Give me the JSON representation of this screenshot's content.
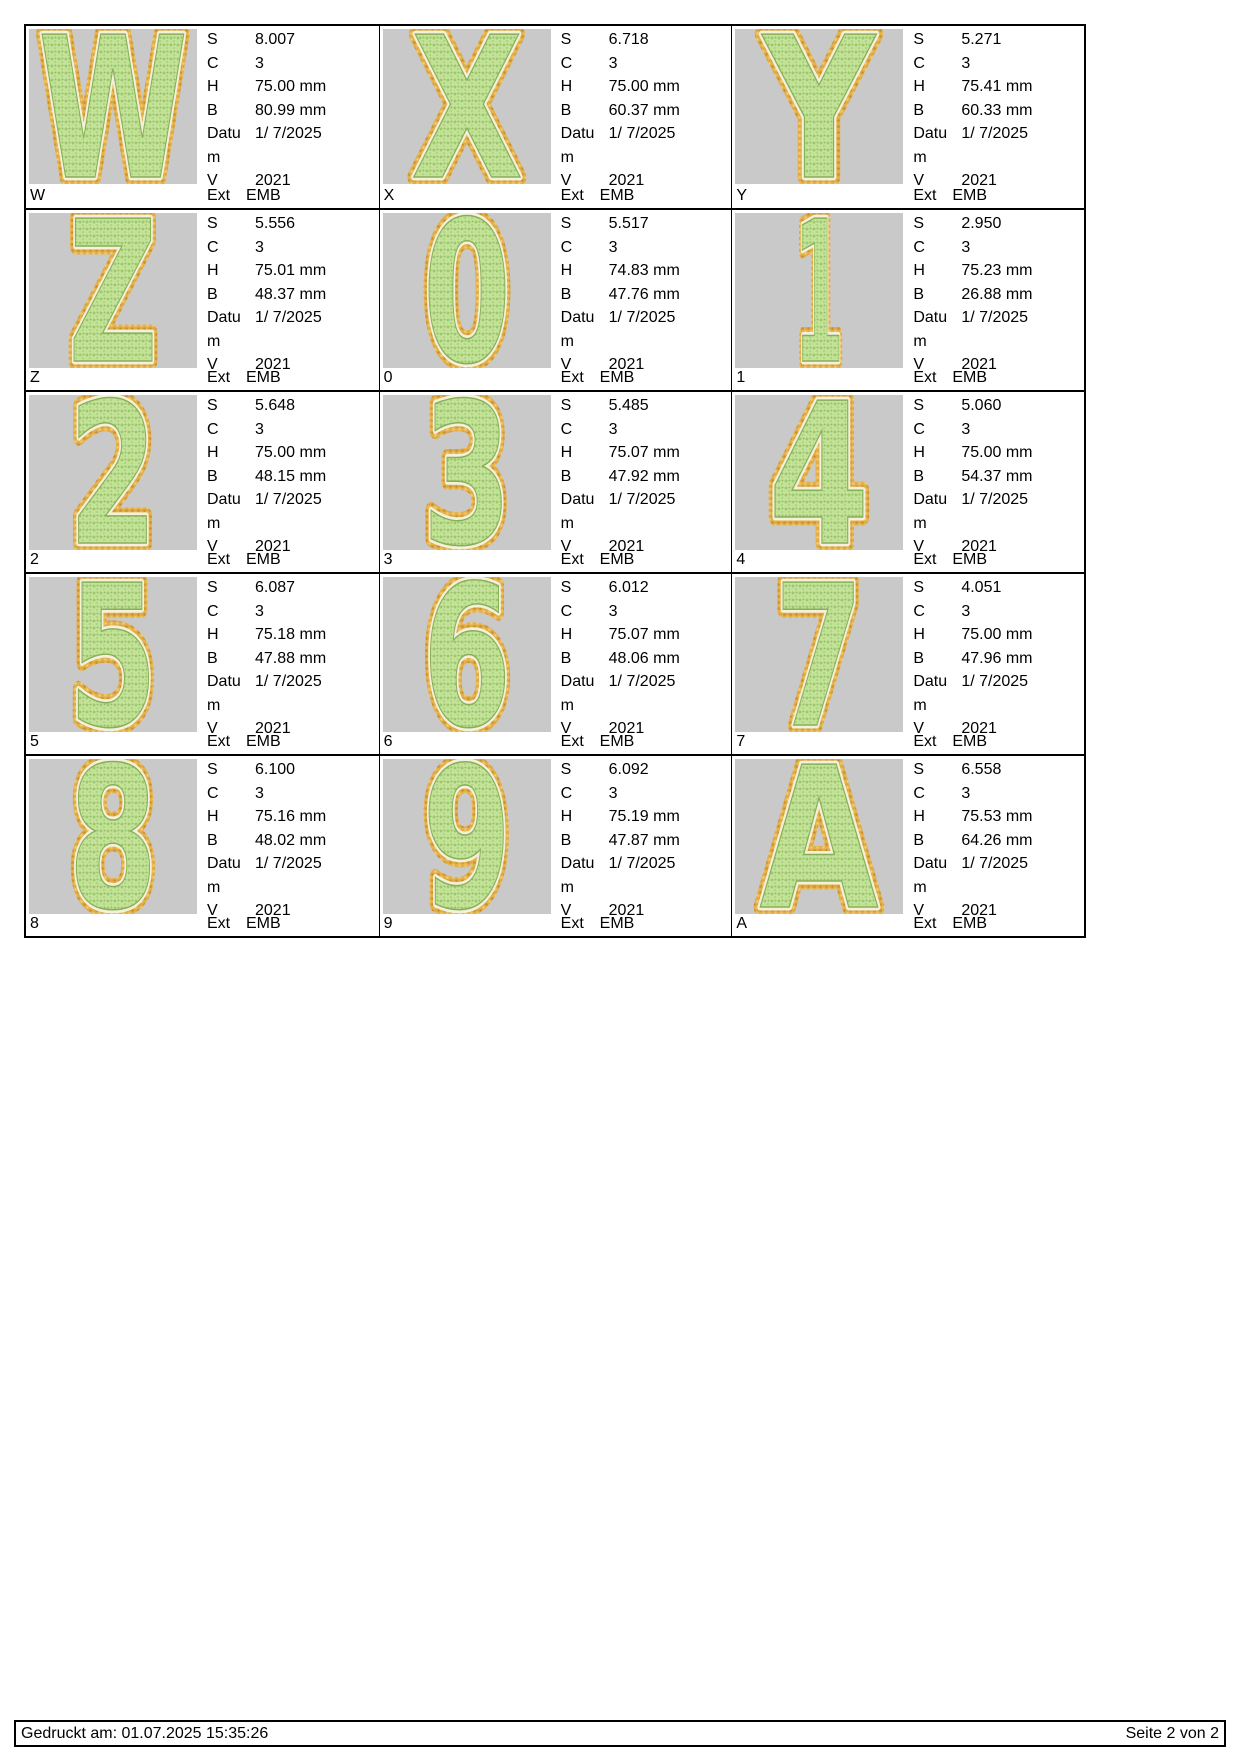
{
  "labels": {
    "s": "S",
    "c": "C",
    "h": "H",
    "b": "B",
    "datum": "Datum",
    "v": "V",
    "ext": "Ext"
  },
  "footer": {
    "printed": "Gedruckt am: 01.07.2025 15:35:26",
    "page_info": "Seite 2 von 2"
  },
  "colors": {
    "preview_background": "#c9c9c9",
    "glyph_fill_green": "#c6e39c",
    "glyph_speckle_green": "#8fbf62",
    "glyph_border_orange": "#e3b04b",
    "glyph_inner_cream": "#f4f0da",
    "line_color": "#000000",
    "page_background": "#ffffff"
  },
  "cells": [
    {
      "glyph": "W",
      "name": "W",
      "s": "8.007",
      "c": "3",
      "h": "75.00 mm",
      "b": "80.99 mm",
      "datum": "1/ 7/2025",
      "v": "2021",
      "format": "EMB"
    },
    {
      "glyph": "X",
      "name": "X",
      "s": "6.718",
      "c": "3",
      "h": "75.00 mm",
      "b": "60.37 mm",
      "datum": "1/ 7/2025",
      "v": "2021",
      "format": "EMB"
    },
    {
      "glyph": "Y",
      "name": "Y",
      "s": "5.271",
      "c": "3",
      "h": "75.41 mm",
      "b": "60.33 mm",
      "datum": "1/ 7/2025",
      "v": "2021",
      "format": "EMB"
    },
    {
      "glyph": "Z",
      "name": "Z",
      "s": "5.556",
      "c": "3",
      "h": "75.01 mm",
      "b": "48.37 mm",
      "datum": "1/ 7/2025",
      "v": "2021",
      "format": "EMB"
    },
    {
      "glyph": "0",
      "name": "0",
      "s": "5.517",
      "c": "3",
      "h": "74.83 mm",
      "b": "47.76 mm",
      "datum": "1/ 7/2025",
      "v": "2021",
      "format": "EMB"
    },
    {
      "glyph": "1",
      "name": "1",
      "s": "2.950",
      "c": "3",
      "h": "75.23 mm",
      "b": "26.88 mm",
      "datum": "1/ 7/2025",
      "v": "2021",
      "format": "EMB"
    },
    {
      "glyph": "2",
      "name": "2",
      "s": "5.648",
      "c": "3",
      "h": "75.00 mm",
      "b": "48.15 mm",
      "datum": "1/ 7/2025",
      "v": "2021",
      "format": "EMB"
    },
    {
      "glyph": "3",
      "name": "3",
      "s": "5.485",
      "c": "3",
      "h": "75.07 mm",
      "b": "47.92 mm",
      "datum": "1/ 7/2025",
      "v": "2021",
      "format": "EMB"
    },
    {
      "glyph": "4",
      "name": "4",
      "s": "5.060",
      "c": "3",
      "h": "75.00 mm",
      "b": "54.37 mm",
      "datum": "1/ 7/2025",
      "v": "2021",
      "format": "EMB"
    },
    {
      "glyph": "5",
      "name": "5",
      "s": "6.087",
      "c": "3",
      "h": "75.18 mm",
      "b": "47.88 mm",
      "datum": "1/ 7/2025",
      "v": "2021",
      "format": "EMB"
    },
    {
      "glyph": "6",
      "name": "6",
      "s": "6.012",
      "c": "3",
      "h": "75.07 mm",
      "b": "48.06 mm",
      "datum": "1/ 7/2025",
      "v": "2021",
      "format": "EMB"
    },
    {
      "glyph": "7",
      "name": "7",
      "s": "4.051",
      "c": "3",
      "h": "75.00 mm",
      "b": "47.96 mm",
      "datum": "1/ 7/2025",
      "v": "2021",
      "format": "EMB"
    },
    {
      "glyph": "8",
      "name": "8",
      "s": "6.100",
      "c": "3",
      "h": "75.16 mm",
      "b": "48.02 mm",
      "datum": "1/ 7/2025",
      "v": "2021",
      "format": "EMB"
    },
    {
      "glyph": "9",
      "name": "9",
      "s": "6.092",
      "c": "3",
      "h": "75.19 mm",
      "b": "47.87 mm",
      "datum": "1/ 7/2025",
      "v": "2021",
      "format": "EMB"
    },
    {
      "glyph": "A",
      "name": "A",
      "s": "6.558",
      "c": "3",
      "h": "75.53 mm",
      "b": "64.26 mm",
      "datum": "1/ 7/2025",
      "v": "2021",
      "format": "EMB"
    }
  ]
}
